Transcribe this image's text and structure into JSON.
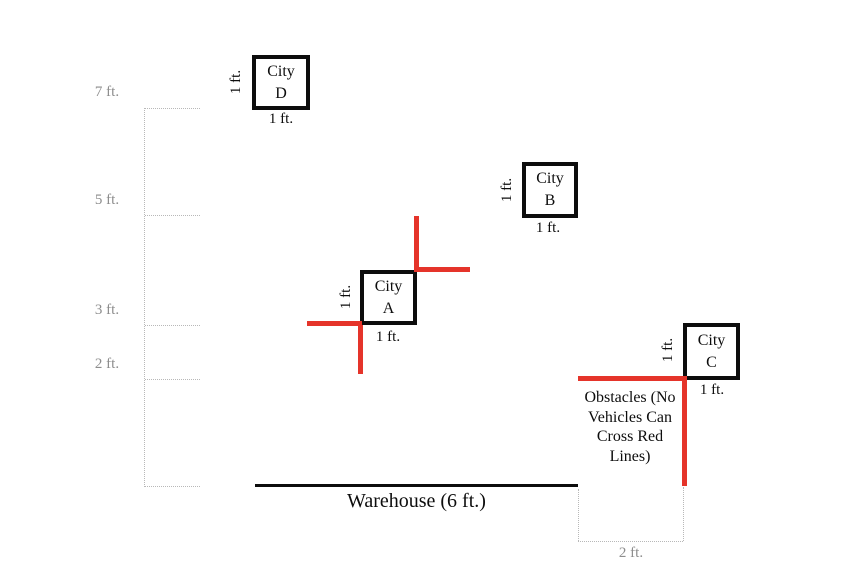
{
  "axis": {
    "labels": [
      "7 ft.",
      "5 ft.",
      "3 ft.",
      "2 ft."
    ]
  },
  "cities": [
    {
      "line1": "City",
      "line2": "D",
      "height_label": "1 ft.",
      "width_label": "1 ft."
    },
    {
      "line1": "City",
      "line2": "B",
      "height_label": "1 ft.",
      "width_label": "1 ft."
    },
    {
      "line1": "City",
      "line2": "A",
      "height_label": "1 ft.",
      "width_label": "1 ft."
    },
    {
      "line1": "City",
      "line2": "C",
      "height_label": "1 ft.",
      "width_label": "1 ft."
    }
  ],
  "warehouse": {
    "label": "Warehouse (6 ft.)"
  },
  "obstacles": {
    "note": "Obstacles (No\nVehicles Can\nCross Red\nLines)"
  },
  "bottom_measure": {
    "label": "2 ft."
  },
  "colors": {
    "obstacle_red": "#e5342a",
    "box_border_black": "#0d0d0d",
    "axis_gray": "#8d8d8d",
    "dotted_gray": "#b8b8b8"
  }
}
